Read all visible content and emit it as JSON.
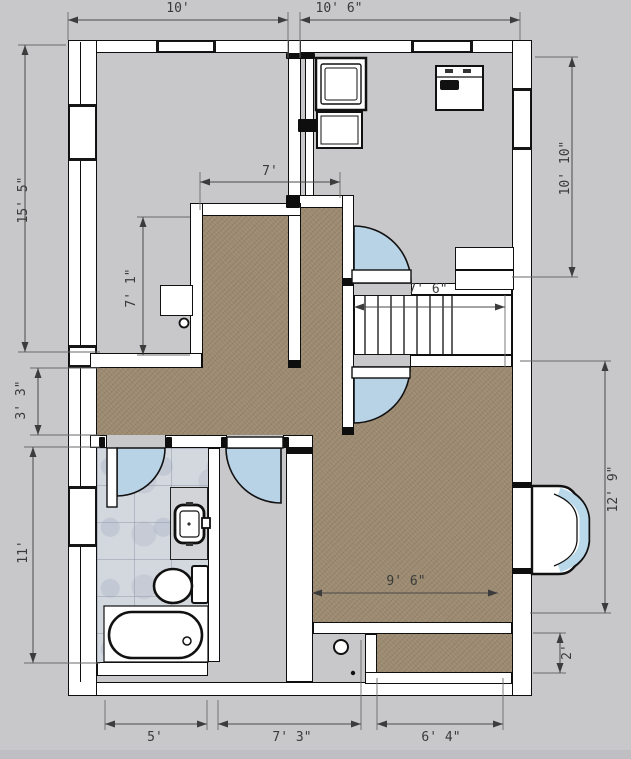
{
  "plan": {
    "view": "floor-plan-top-view",
    "dims": {
      "top_left": "10'",
      "top_right": "10' 6\"",
      "left_upper": "15' 5\"",
      "left_mid": "3' 3\"",
      "left_lower": "11'",
      "right_upper": "10' 10\"",
      "right_lower": "12' 9\"",
      "right_closet": "2'",
      "room_width": "7'",
      "room_height": "7' 1\"",
      "stairs_width": "7' 6\"",
      "big_room_width": "9' 6\"",
      "bottom_left": "5'",
      "bottom_mid": "7' 3\"",
      "bottom_right": "6' 4\""
    },
    "fixtures": [
      "bathtub",
      "toilet",
      "sink-vanity",
      "door-swing",
      "stairs",
      "bay-window",
      "cabinet",
      "appliance",
      "window",
      "floor-drain"
    ],
    "colors": {
      "background": "#c8c8cb",
      "wall_fill": "#ffffff",
      "wall_line": "#0e0e0e",
      "carpet": "#9c8a71",
      "tile": "#d3d7de",
      "door_swing": "#b9d3e6",
      "bay_glass": "#b9d9ea",
      "dimension_text": "#3a3a3a"
    }
  }
}
